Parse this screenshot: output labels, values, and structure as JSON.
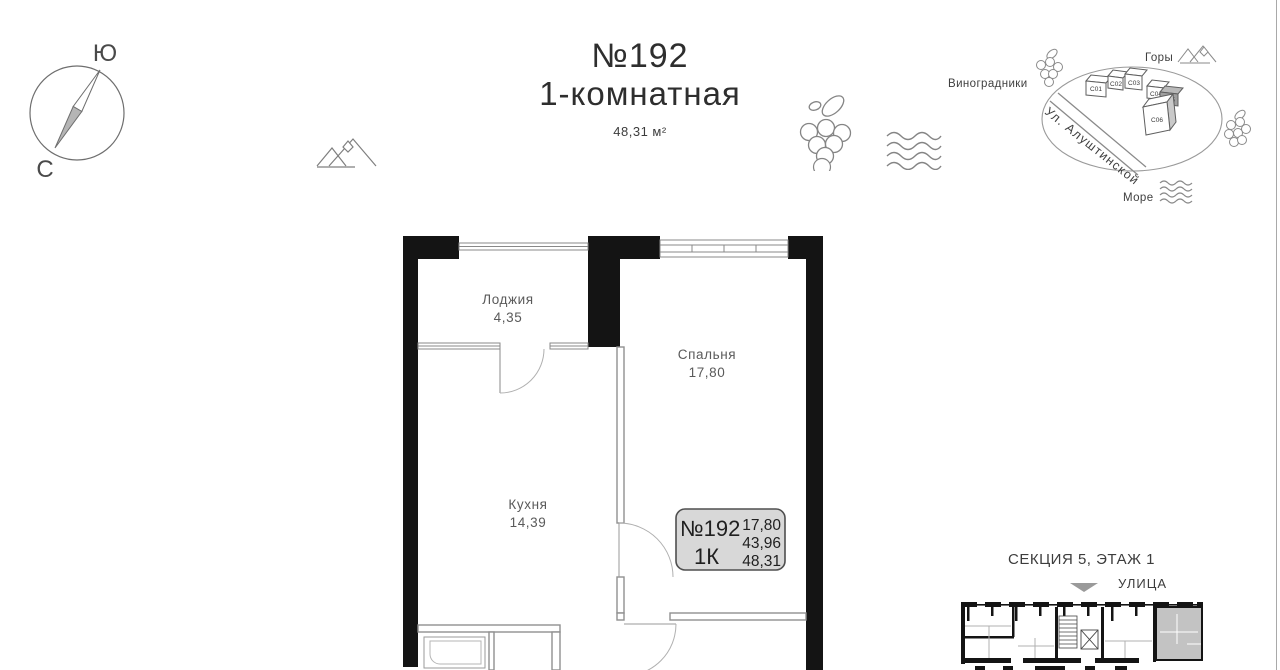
{
  "compass": {
    "south": "Ю",
    "north": "С"
  },
  "header": {
    "apartment_number": "№192",
    "apartment_type": "1-комнатная",
    "total_area": "48,31 м²"
  },
  "location_map": {
    "vineyards": "Виноградники",
    "mountains": "Горы",
    "sea": "Море",
    "street": "Ул. Алуштинской",
    "buildings": [
      "C01",
      "C02",
      "C03",
      "C04",
      "C05",
      "C06"
    ],
    "highlighted_building": "C05"
  },
  "floor_plan": {
    "loggia": {
      "name": "Лоджия",
      "area": "4,35"
    },
    "bedroom": {
      "name": "Спальня",
      "area": "17,80"
    },
    "kitchen": {
      "name": "Кухня",
      "area": "14,39"
    },
    "info_box": {
      "number": "№192",
      "rooms": "1К",
      "area_living": "17,80",
      "area_main": "43,96",
      "area_total": "48,31"
    }
  },
  "section_plan": {
    "title": "СЕКЦИЯ 5, ЭТАЖ 1",
    "street": "УЛИЦА"
  },
  "colors": {
    "wall": "#141414",
    "interior_wall": "#909090",
    "highlight_fill": "#c3c3c3",
    "info_box_fill": "#d8d8d8"
  }
}
